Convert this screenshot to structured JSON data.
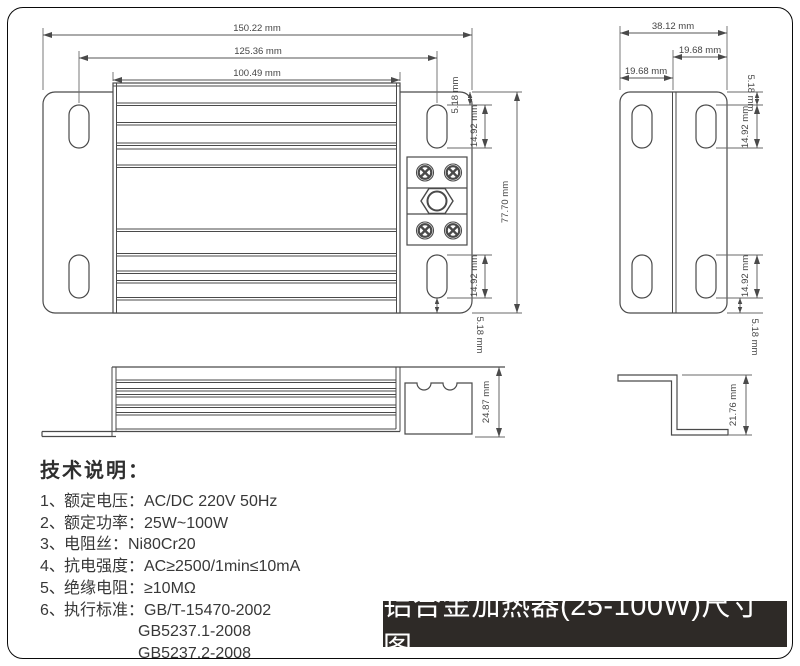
{
  "views": {
    "front": {
      "dims": {
        "total_width": "150.22 mm",
        "slot_span": "125.36 mm",
        "body_width": "100.49 mm",
        "top_edge_to_slot": "5.18 mm",
        "slot_length_top": "14.92 mm",
        "overall_height": "77.70 mm",
        "slot_length_bottom": "14.92 mm",
        "slot_to_bottom_edge": "5.18 mm"
      }
    },
    "side": {
      "dims": {
        "total_width": "38.12 mm",
        "right_half": "19.68 mm",
        "left_half": "19.68 mm",
        "top_edge_to_slot": "5.18 mm",
        "slot_length_top": "14.92 mm",
        "slot_length_bottom": "14.92 mm",
        "slot_to_bottom_edge": "5.18 mm"
      }
    },
    "profile": {
      "dims": {
        "height": "24.87 mm"
      }
    },
    "bracket": {
      "dims": {
        "height": "21.76 mm"
      }
    }
  },
  "specs": {
    "title": "技术说明：",
    "items": [
      {
        "no": "1、",
        "text": "额定电压：AC/DC 220V 50Hz"
      },
      {
        "no": "2、",
        "text": "额定功率：25W~100W"
      },
      {
        "no": "3、",
        "text": "电阻丝：Ni80Cr20"
      },
      {
        "no": "4、",
        "text": "抗电强度：AC≥2500/1min≤10mA"
      },
      {
        "no": "5、",
        "text": "绝缘电阻：≥10MΩ"
      },
      {
        "no": "6、",
        "text": "执行标准：GB/T-15470-2002"
      },
      {
        "no": "",
        "text": "GB5237.1-2008"
      },
      {
        "no": "",
        "text": "GB5237.2-2008"
      }
    ]
  },
  "banner": {
    "title": "铝合金加热器(25-100W)尺寸图",
    "bg_color": "#2e2a27",
    "text_color": "#ffffff"
  },
  "drawing": {
    "line_color": "#4a4a4a",
    "dim_text_color": "#454545"
  }
}
